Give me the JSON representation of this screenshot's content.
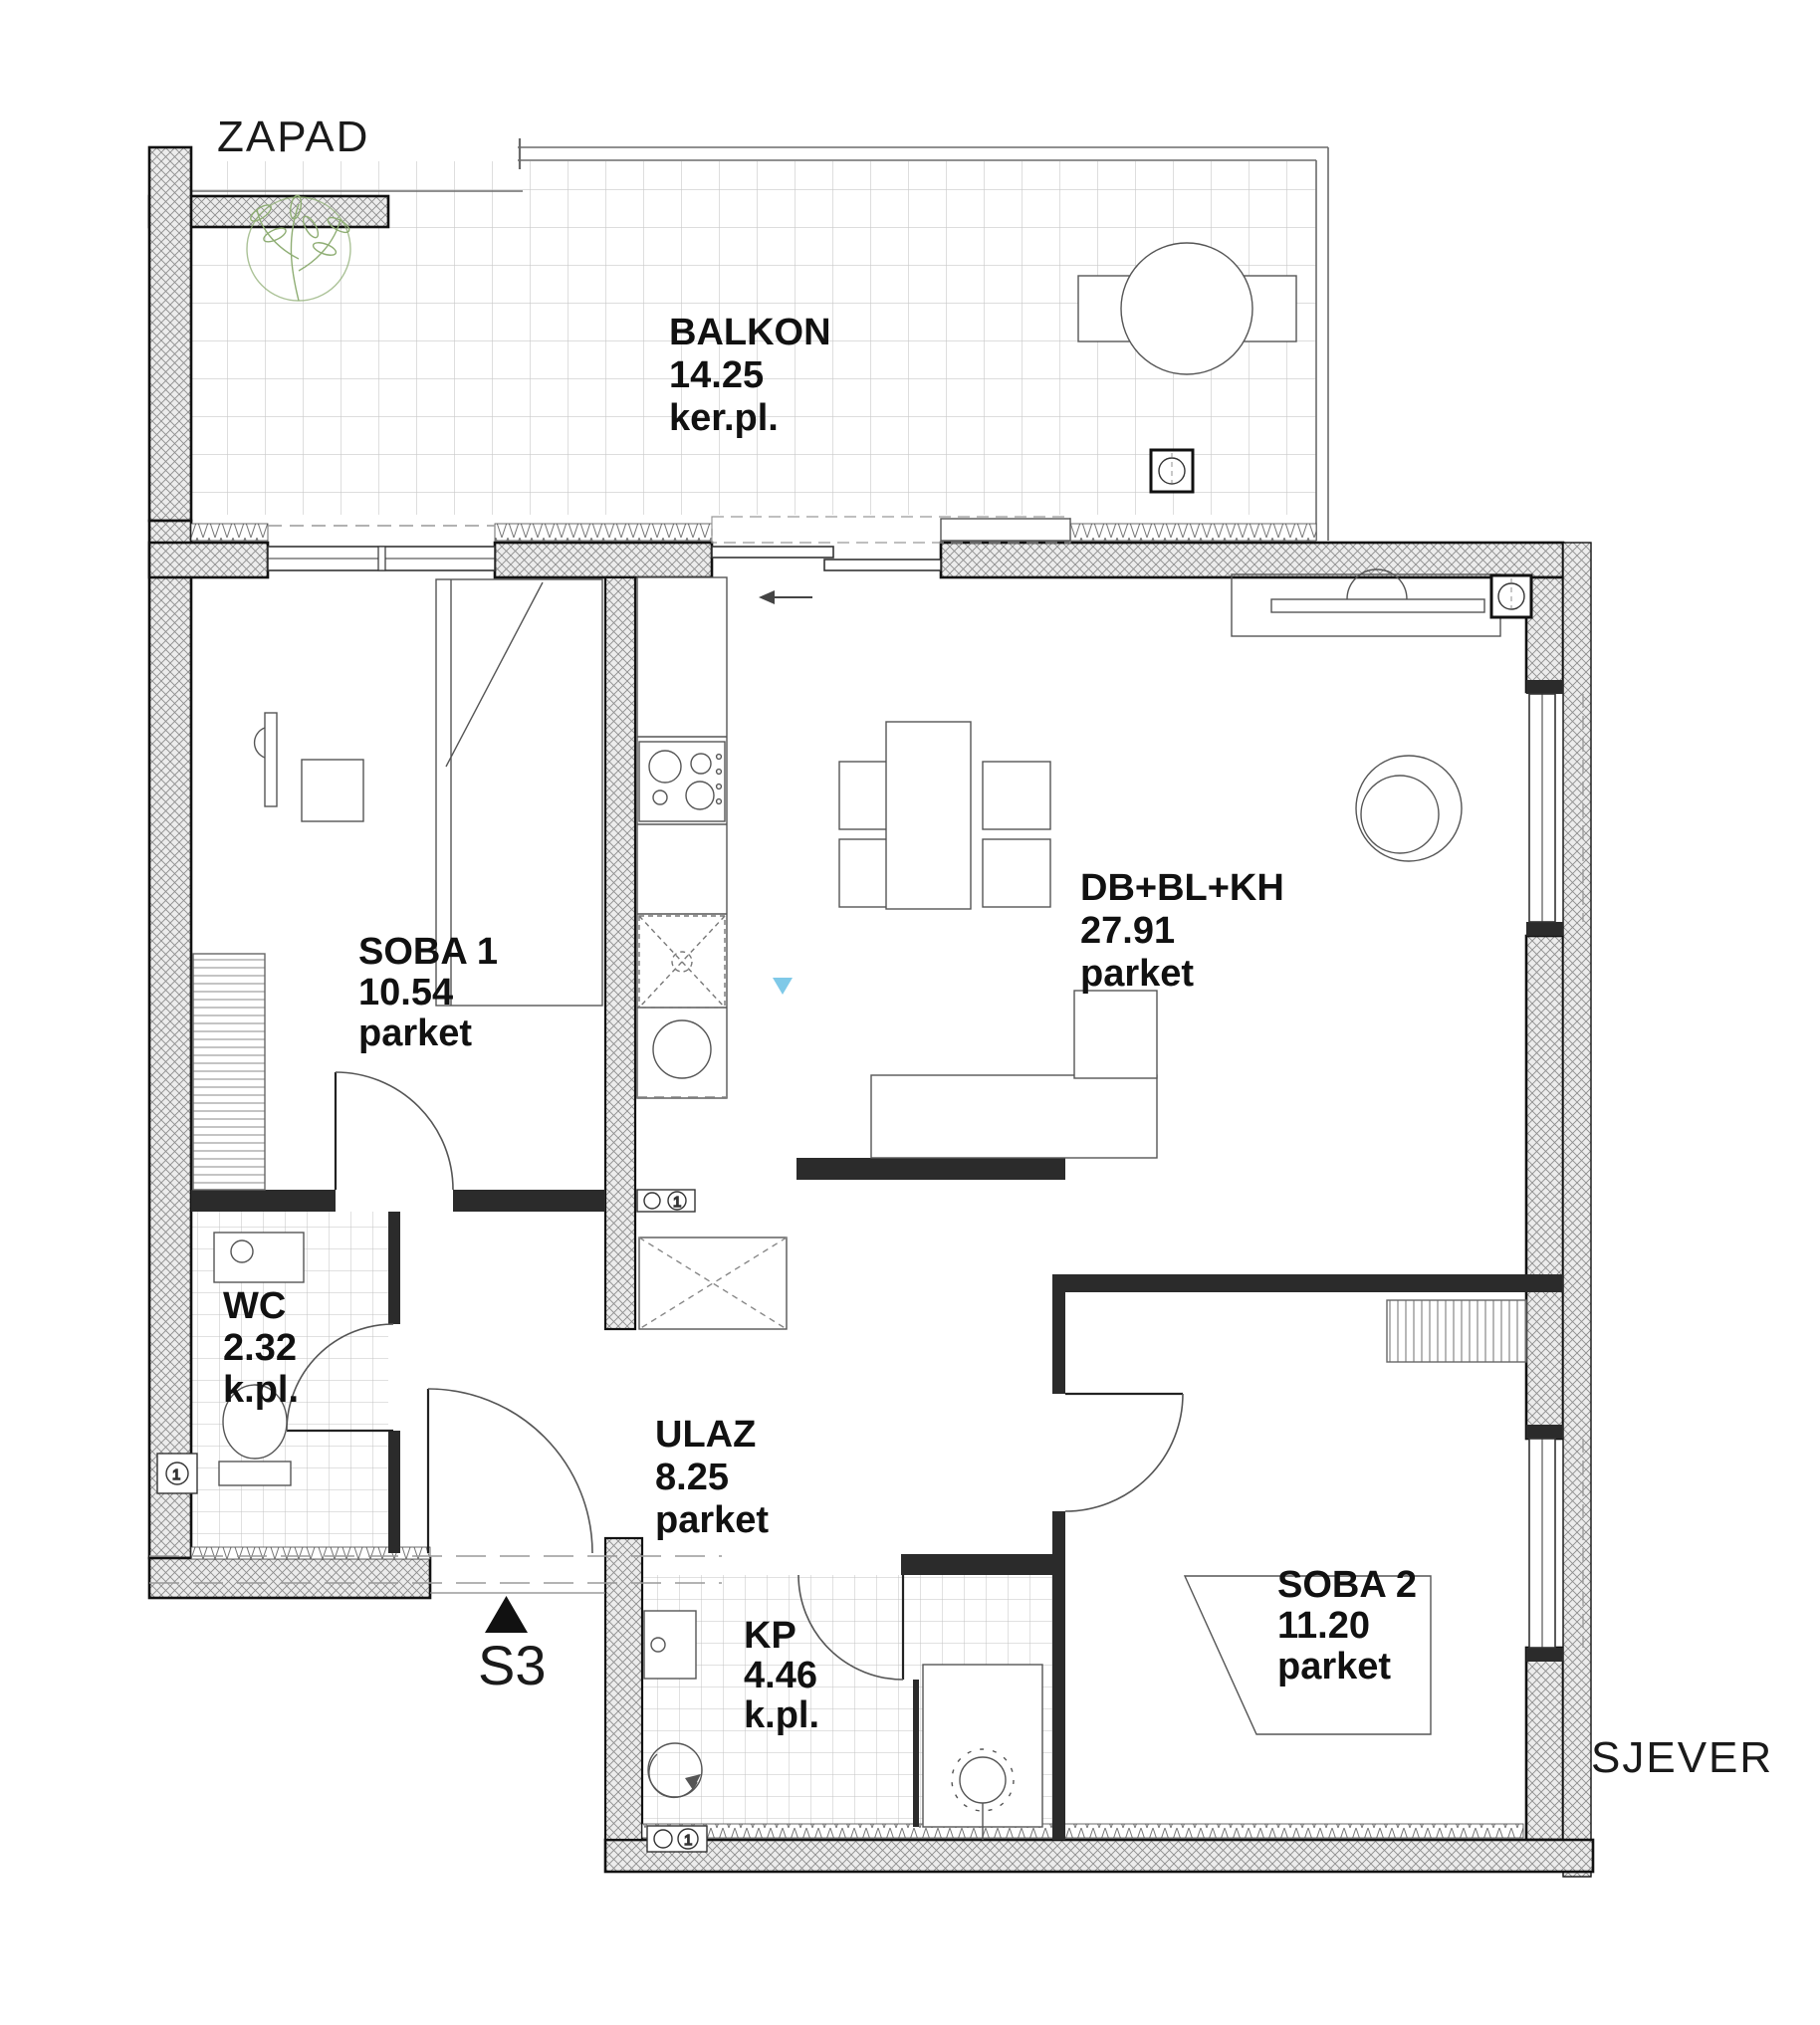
{
  "title": "Apartment S3 floor plan",
  "orientation": {
    "west": "ZAPAD",
    "north": "SJEVER"
  },
  "section_marker": {
    "label": "S3"
  },
  "symbols": {
    "circuit": "1"
  },
  "colors": {
    "wall_hatch": "#8d8d8d",
    "tile_line": "#c9c9c9",
    "plant_green": "#8fae74",
    "marker_blue": "#7fc9e8",
    "ink": "#111111"
  },
  "rooms": [
    {
      "id": "balkon",
      "name": "BALKON",
      "area": "14.25",
      "floor": "ker.pl."
    },
    {
      "id": "soba1",
      "name": "SOBA 1",
      "area": "10.54",
      "floor": "parket"
    },
    {
      "id": "db",
      "name": "DB+BL+KH",
      "area": "27.91",
      "floor": "parket"
    },
    {
      "id": "wc",
      "name": "WC",
      "area": "2.32",
      "floor": "k.pl."
    },
    {
      "id": "ulaz",
      "name": "ULAZ",
      "area": "8.25",
      "floor": "parket"
    },
    {
      "id": "kp",
      "name": "KP",
      "area": "4.46",
      "floor": "k.pl."
    },
    {
      "id": "soba2",
      "name": "SOBA 2",
      "area": "11.20",
      "floor": "parket"
    }
  ]
}
